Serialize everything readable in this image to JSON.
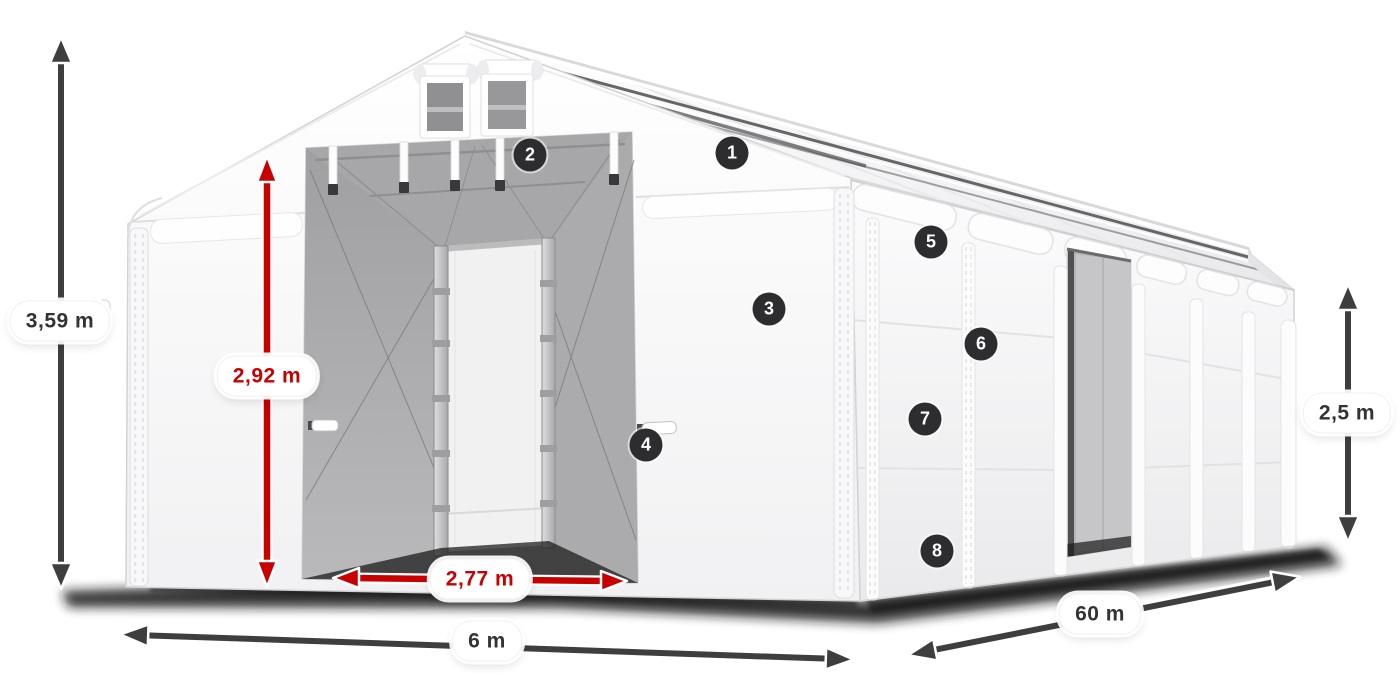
{
  "diagram": {
    "type": "product-dimension-diagram",
    "subject": "storage-tent-with-open-gable-entrance",
    "measurements": {
      "total_height": "3,59 m",
      "entrance_height": "2,92 m",
      "entrance_width": "2,77 m",
      "width": "6 m",
      "length": "60 m",
      "side_wall_height": "2,5 m"
    },
    "callouts": [
      {
        "number": "1"
      },
      {
        "number": "2"
      },
      {
        "number": "3"
      },
      {
        "number": "4"
      },
      {
        "number": "5"
      },
      {
        "number": "6"
      },
      {
        "number": "7"
      },
      {
        "number": "8"
      }
    ],
    "colors": {
      "outer_dimension_arrow": "#3e3e41",
      "inner_dimension_arrow": "#c70000",
      "callout_badge": "#2d2d30",
      "label_text": "#333336",
      "background": "#ffffff"
    }
  }
}
